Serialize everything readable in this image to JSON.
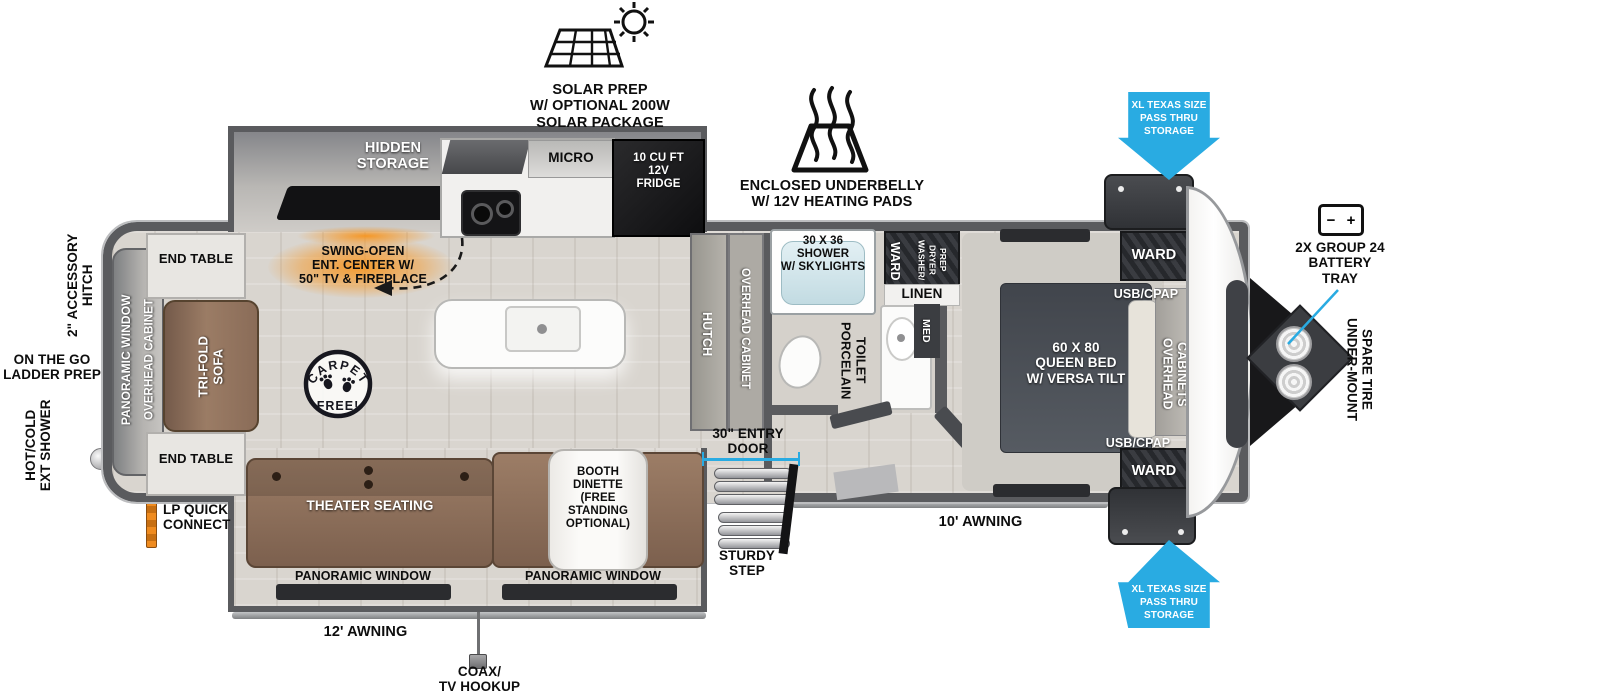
{
  "exterior_callouts": {
    "solar_prep": "SOLAR PREP\nW/ OPTIONAL 200W\nSOLAR PACKAGE",
    "enclosed_underbelly": "ENCLOSED UNDERBELLY\nW/ 12V HEATING PADS",
    "pass_thru_storage_top": "XL TEXAS SIZE\nPASS THRU\nSTORAGE",
    "pass_thru_storage_bottom": "XL TEXAS SIZE\nPASS THRU\nSTORAGE",
    "battery_tray": "2X GROUP 24\nBATTERY\nTRAY",
    "spare_tire": "UNDER-MOUNT\nSPARE TIRE",
    "accessory_hitch": "2\" ACCESSORY\nHITCH",
    "ladder_prep": "ON THE GO\nLADDER PREP",
    "ext_shower": "HOT/COLD\nEXT SHOWER",
    "lp_quick_connect": "LP QUICK\nCONNECT",
    "awning_rear": "12' AWNING",
    "awning_front": "10' AWNING",
    "coax_tv": "COAX/\nTV HOOKUP",
    "entry_door": "30\" ENTRY\nDOOR",
    "sturdy_step": "STURDY\nSTEP"
  },
  "interior_labels": {
    "hidden_storage": "HIDDEN\nSTORAGE",
    "micro": "MICRO",
    "fridge": "10 CU FT\n12V\nFRIDGE",
    "ent_center": "SWING-OPEN\nENT. CENTER W/\n50\" TV & FIREPLACE",
    "carpet_free_top": "CARPET",
    "carpet_free_bottom": "FREE!",
    "end_table_top": "END TABLE",
    "end_table_bottom": "END TABLE",
    "tri_fold_sofa": "TRI-FOLD\nSOFA",
    "panoramic_window_rear": "PANORAMIC WINDOW",
    "overhead_cabinet_rear": "OVERHEAD CABINET",
    "theater_seating": "THEATER SEATING",
    "booth_dinette": "BOOTH\nDINETTE\n(FREE\nSTANDING\nOPTIONAL)",
    "panoramic_window_left": "PANORAMIC WINDOW",
    "panoramic_window_right": "PANORAMIC WINDOW",
    "hutch": "HUTCH",
    "overhead_cabinet_mid": "OVERHEAD CABINET",
    "shower": "30 X 36\nSHOWER\nW/ SKYLIGHTS",
    "porcelain_toilet": "PORCELAIN\nTOILET",
    "linen": "LINEN",
    "med": "MED",
    "ward_bath": "WARD",
    "washer_dryer_prep": "WASHER/\nDRYER\nPREP",
    "queen_bed": "60 X 80\nQUEEN BED\nW/ VERSA TILT",
    "usb_cpap_top": "USB/CPAP",
    "usb_cpap_bottom": "USB/CPAP",
    "overhead_cabinets_bed": "OVERHEAD\nCABINETS",
    "ward_bed_top": "WARD",
    "ward_bed_bottom": "WARD"
  },
  "icons": {
    "battery_minus": "−",
    "battery_plus": "+"
  },
  "colors": {
    "callout_blue": "#29abe2",
    "accent_orange": "#f7941d",
    "wall_gray": "#5a5b5e",
    "furniture_brown": "#8d7260",
    "appliance_black": "#141416",
    "bed_slate": "#4a4f56"
  }
}
